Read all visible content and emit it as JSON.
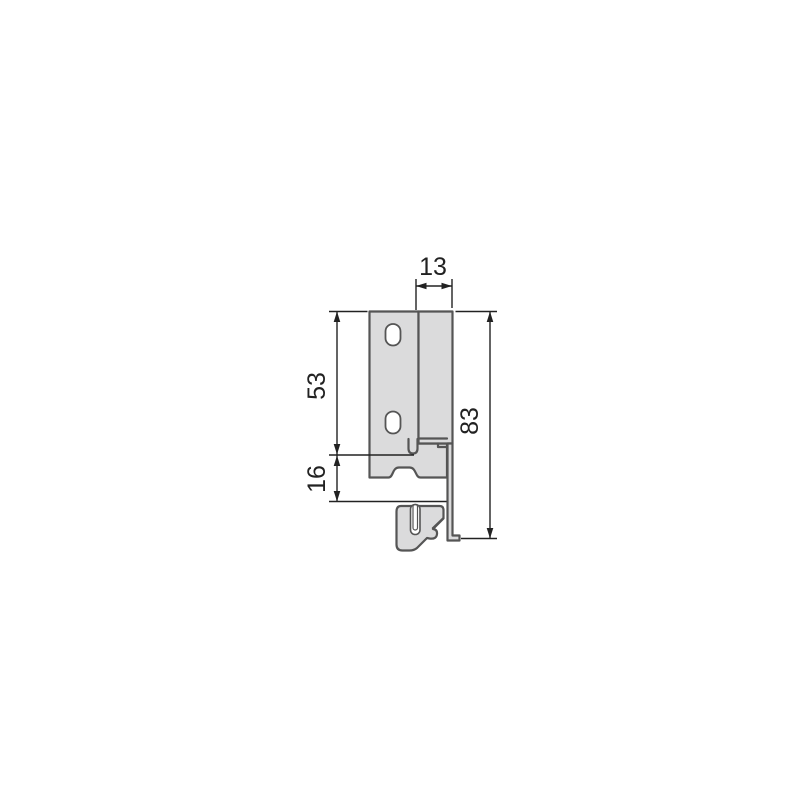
{
  "colors": {
    "background": "#ffffff",
    "profile_fill": "#dbdbdc",
    "profile_outline": "#555555",
    "hole_fill": "#ffffff",
    "dimension": "#222222"
  },
  "drawing": {
    "kind": "drawer-side-profile-cross-section",
    "dimensions": {
      "top_width": "13",
      "upper_height": "53",
      "lower_height": "16",
      "total_height": "83"
    }
  }
}
